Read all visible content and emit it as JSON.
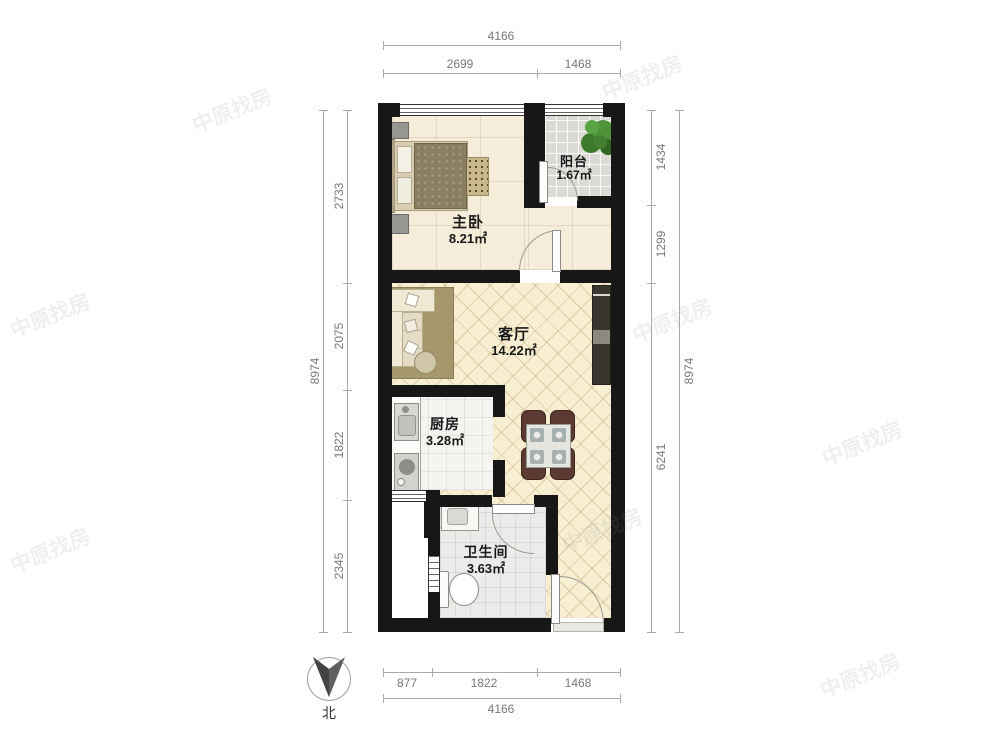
{
  "rooms": {
    "bedroom": {
      "name": "主卧",
      "area": "8.21㎡"
    },
    "balcony": {
      "name": "阳台",
      "area": "1.67㎡"
    },
    "living": {
      "name": "客厅",
      "area": "14.22㎡"
    },
    "kitchen": {
      "name": "厨房",
      "area": "3.28㎡"
    },
    "bathroom": {
      "name": "卫生间",
      "area": "3.63㎡"
    }
  },
  "dimensions": {
    "top": {
      "total": "4166",
      "segments": [
        "2699",
        "1468"
      ]
    },
    "bottom": {
      "total": "4166",
      "segments": [
        "877",
        "1822",
        "1468"
      ]
    },
    "left": {
      "total": "8974",
      "segments": [
        "2733",
        "2075",
        "1822",
        "2345"
      ]
    },
    "right": {
      "total": "8974",
      "segments": [
        "1434",
        "1299",
        "6241"
      ]
    }
  },
  "compass": {
    "label": "北"
  },
  "watermark": {
    "text": "中原找房"
  },
  "colors": {
    "wall": "#171717",
    "living_floor": "#f8efd2",
    "bedroom_floor": "#f5ecd9",
    "balcony_floor": "#dcdad5",
    "kitchen_floor": "#f4f4f1",
    "bathroom_floor": "#ebebe9",
    "dimension_text": "#777777",
    "dining_chair": "#5c3a31",
    "plant": "#4f9339"
  }
}
